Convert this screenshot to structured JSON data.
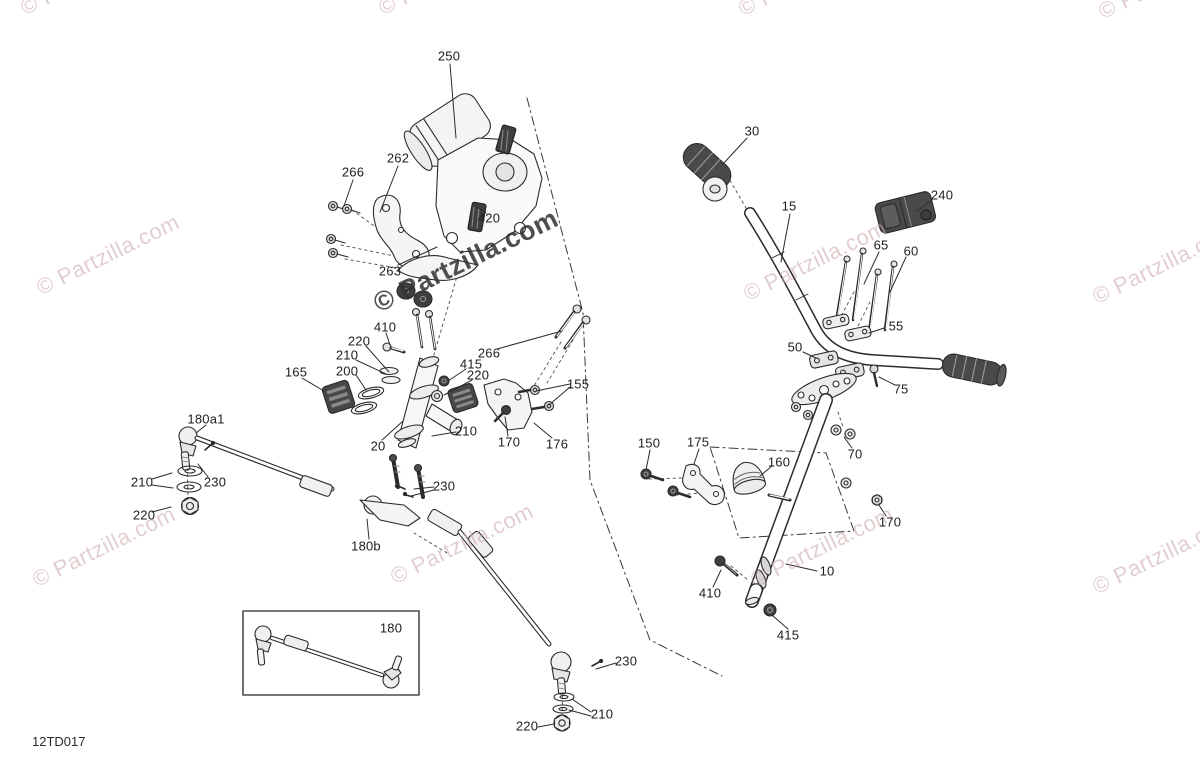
{
  "diagram": {
    "code": "12TD017",
    "watermark_text": "© Partzilla.com",
    "colors": {
      "watermark_pink": "#cba6a8",
      "watermark_dark": "#303030",
      "line": "#2b2b2b"
    },
    "inset": {
      "label": "180"
    },
    "part_labels": [
      {
        "text": "250",
        "x": 449,
        "y": 56
      },
      {
        "text": "262",
        "x": 398,
        "y": 158
      },
      {
        "text": "266",
        "x": 353,
        "y": 172
      },
      {
        "text": "420",
        "x": 489,
        "y": 218
      },
      {
        "text": "263",
        "x": 390,
        "y": 271
      },
      {
        "text": "410",
        "x": 385,
        "y": 327
      },
      {
        "text": "220",
        "x": 359,
        "y": 341
      },
      {
        "text": "210",
        "x": 347,
        "y": 355
      },
      {
        "text": "200",
        "x": 347,
        "y": 371
      },
      {
        "text": "165",
        "x": 296,
        "y": 372
      },
      {
        "text": "266",
        "x": 489,
        "y": 353
      },
      {
        "text": "415",
        "x": 471,
        "y": 364
      },
      {
        "text": "220",
        "x": 478,
        "y": 375
      },
      {
        "text": "155",
        "x": 578,
        "y": 384
      },
      {
        "text": "20",
        "x": 378,
        "y": 446
      },
      {
        "text": "210",
        "x": 466,
        "y": 431
      },
      {
        "text": "170",
        "x": 509,
        "y": 442
      },
      {
        "text": "176",
        "x": 557,
        "y": 444
      },
      {
        "text": "180a1",
        "x": 206,
        "y": 419
      },
      {
        "text": "210",
        "x": 142,
        "y": 482
      },
      {
        "text": "230",
        "x": 215,
        "y": 482
      },
      {
        "text": "220",
        "x": 144,
        "y": 515
      },
      {
        "text": "230",
        "x": 444,
        "y": 486
      },
      {
        "text": "180b",
        "x": 366,
        "y": 546
      },
      {
        "text": "180",
        "x": 391,
        "y": 628
      },
      {
        "text": "230",
        "x": 626,
        "y": 661
      },
      {
        "text": "210",
        "x": 602,
        "y": 714
      },
      {
        "text": "220",
        "x": 527,
        "y": 726
      },
      {
        "text": "30",
        "x": 752,
        "y": 131
      },
      {
        "text": "15",
        "x": 789,
        "y": 206
      },
      {
        "text": "240",
        "x": 942,
        "y": 195
      },
      {
        "text": "65",
        "x": 881,
        "y": 245
      },
      {
        "text": "60",
        "x": 911,
        "y": 251
      },
      {
        "text": "55",
        "x": 896,
        "y": 326
      },
      {
        "text": "50",
        "x": 795,
        "y": 347
      },
      {
        "text": "75",
        "x": 901,
        "y": 389
      },
      {
        "text": "70",
        "x": 855,
        "y": 454
      },
      {
        "text": "150",
        "x": 649,
        "y": 443
      },
      {
        "text": "175",
        "x": 698,
        "y": 442
      },
      {
        "text": "160",
        "x": 779,
        "y": 462
      },
      {
        "text": "170",
        "x": 890,
        "y": 522
      },
      {
        "text": "10",
        "x": 827,
        "y": 571
      },
      {
        "text": "410",
        "x": 710,
        "y": 593
      },
      {
        "text": "415",
        "x": 788,
        "y": 635
      }
    ],
    "watermarks": [
      {
        "variant": "pink",
        "x": 92,
        "y": -25
      },
      {
        "variant": "pink",
        "x": 450,
        "y": -25
      },
      {
        "variant": "pink",
        "x": 810,
        "y": -24
      },
      {
        "variant": "pink",
        "x": 1170,
        "y": -21
      },
      {
        "variant": "pink",
        "x": 108,
        "y": 255
      },
      {
        "variant": "dark",
        "x": 466,
        "y": 261
      },
      {
        "variant": "pink",
        "x": 815,
        "y": 261
      },
      {
        "variant": "pink",
        "x": 1164,
        "y": 264
      },
      {
        "variant": "pink",
        "x": 104,
        "y": 547
      },
      {
        "variant": "pink",
        "x": 462,
        "y": 544
      },
      {
        "variant": "pink",
        "x": 822,
        "y": 547
      },
      {
        "variant": "pink",
        "x": 1164,
        "y": 554
      }
    ]
  }
}
